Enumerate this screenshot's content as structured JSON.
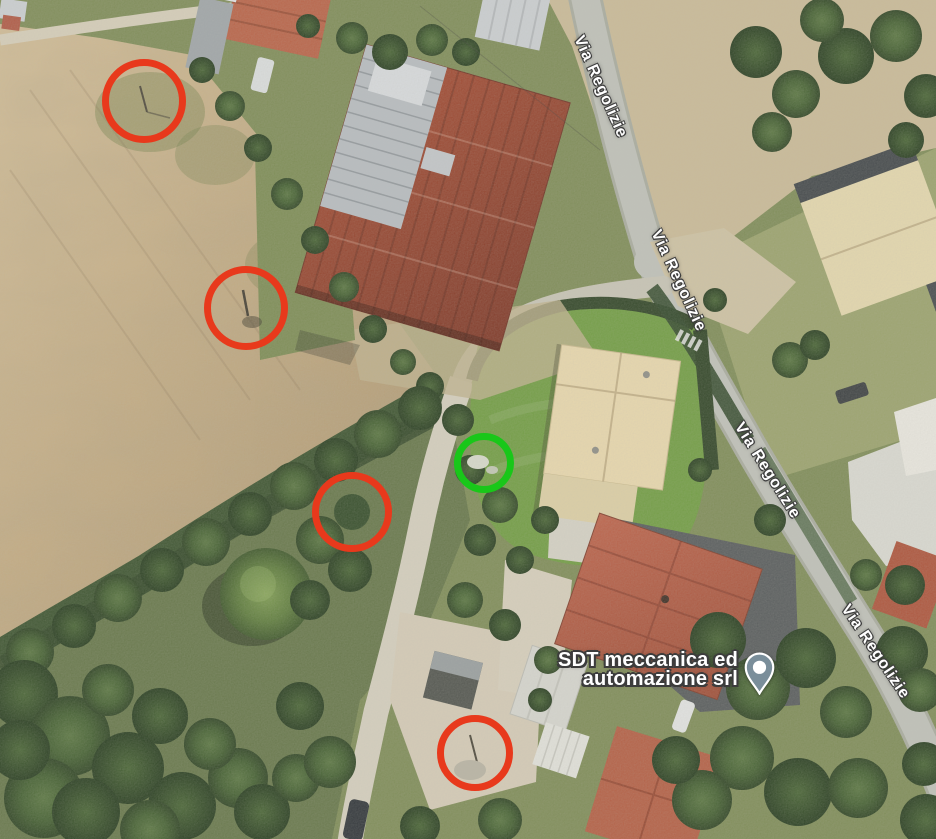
{
  "road_labels": [
    {
      "text": "Via Regolizie",
      "x": 600,
      "y": 87,
      "rotation": 66
    },
    {
      "text": "Via Regolizie",
      "x": 678,
      "y": 281,
      "rotation": 65
    },
    {
      "text": "Via Regolizie",
      "x": 767,
      "y": 471,
      "rotation": 58
    },
    {
      "text": "Via Regolizie",
      "x": 875,
      "y": 652,
      "rotation": 56
    }
  ],
  "business_label": {
    "line1": "SDT meccanica ed",
    "line2": "automazione srl",
    "pin_color": "#7a8e9a"
  },
  "annotations": {
    "red_color": "#e8391c",
    "green_color": "#19c719",
    "stroke_width": 7,
    "circles": [
      {
        "kind": "red",
        "cx": 144,
        "cy": 101,
        "r": 42
      },
      {
        "kind": "red",
        "cx": 246,
        "cy": 308,
        "r": 42
      },
      {
        "kind": "red",
        "cx": 352,
        "cy": 512,
        "r": 40
      },
      {
        "kind": "red",
        "cx": 475,
        "cy": 753,
        "r": 38
      },
      {
        "kind": "green",
        "cx": 484,
        "cy": 463,
        "r": 30
      }
    ]
  }
}
